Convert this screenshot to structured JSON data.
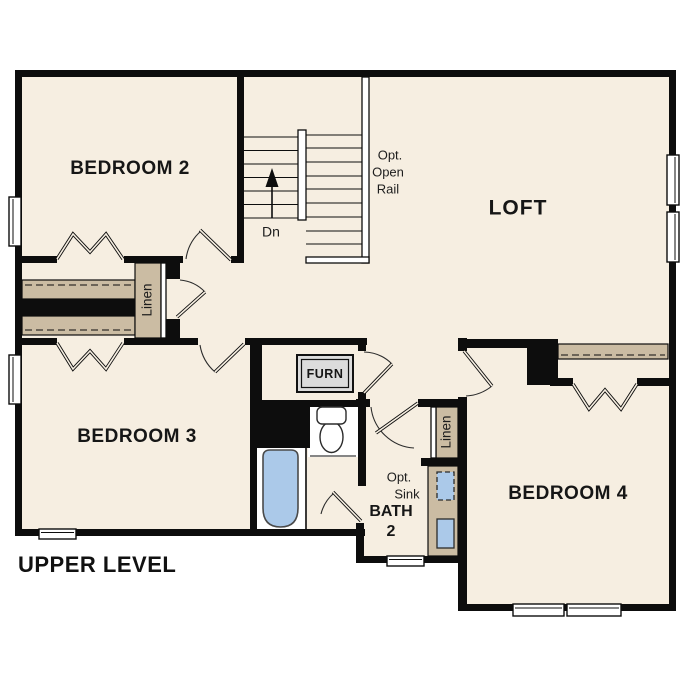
{
  "plan_title": "UPPER LEVEL",
  "rooms": {
    "bedroom2": "BEDROOM 2",
    "bedroom3": "BEDROOM 3",
    "bedroom4": "BEDROOM 4",
    "loft": "LOFT",
    "bath_line1": "BATH",
    "bath_line2": "2"
  },
  "closets": {
    "hall_linen": "Linen",
    "bath_linen": "Linen"
  },
  "stairs": {
    "down_label": "Dn",
    "opt_rail_1": "Opt.",
    "opt_rail_2": "Open",
    "opt_rail_3": "Rail"
  },
  "bath": {
    "opt_sink_1": "Opt.",
    "opt_sink_2": "Sink"
  },
  "furnace_label": "FURN",
  "colors": {
    "floor": "#f6eee1",
    "wall": "#0d0d0d",
    "shelf_tan": "#cbbca3",
    "fixture_blue": "#abc9e9",
    "furnace_gray": "#dcdcdc",
    "background": "#ffffff"
  }
}
